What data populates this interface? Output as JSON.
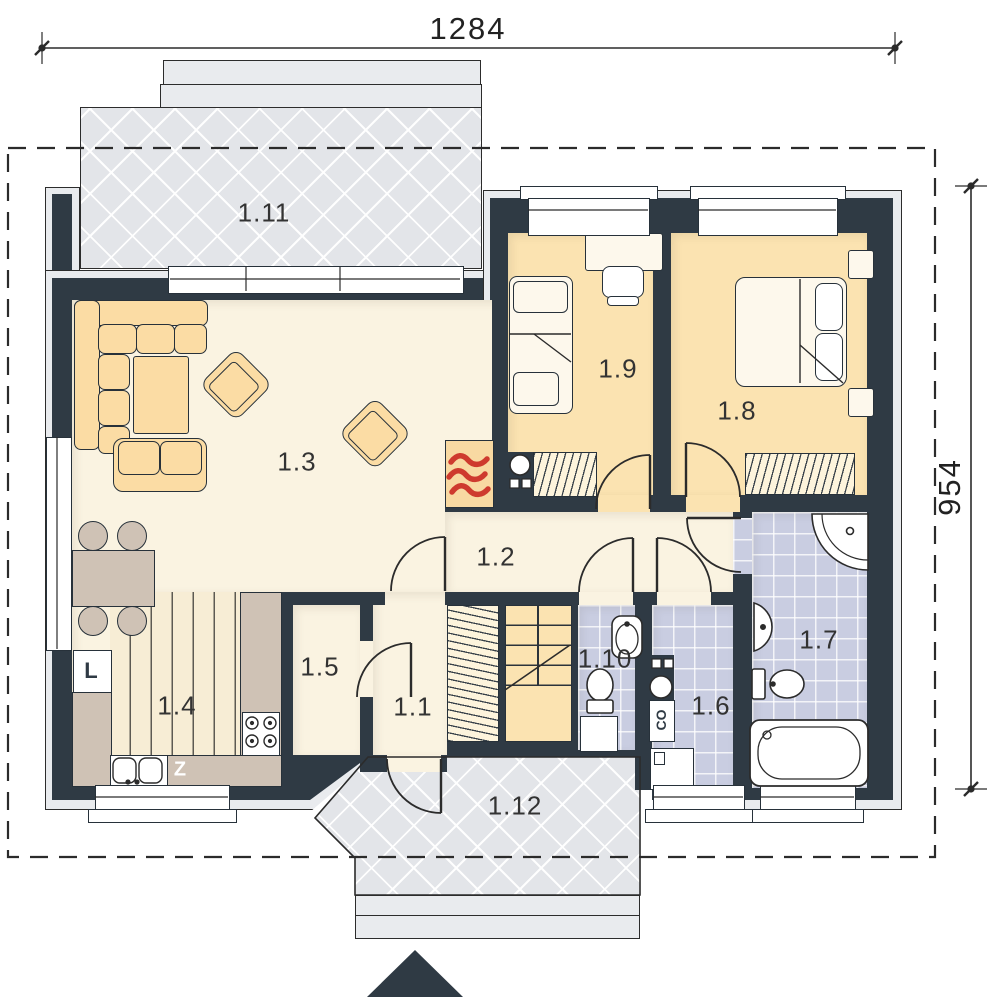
{
  "title": "house ground floor plan",
  "dimensions": {
    "width": "1284",
    "height": "954"
  },
  "rooms": {
    "r1_1": "1.1",
    "r1_2": "1.2",
    "r1_3": "1.3",
    "r1_4": "1.4",
    "r1_5": "1.5",
    "r1_6": "1.6",
    "r1_7": "1.7",
    "r1_8": "1.8",
    "r1_9": "1.9",
    "r1_10": "1.10",
    "r1_11": "1.11",
    "r1_12": "1.12"
  },
  "appliances": {
    "fridge": "L",
    "sink_unit": "Z",
    "central_heating": "CO"
  },
  "palette": {
    "wall": "#2f3a44",
    "floor_main": "#faf3e1",
    "floor_bedroom": "#fbe3b1",
    "floor_tile": "#c9cde1",
    "terrace": "#e3e5e9",
    "furniture": "#fbdca4",
    "counter": "#cfc2b5",
    "accent_red": "#ce3a2e"
  }
}
